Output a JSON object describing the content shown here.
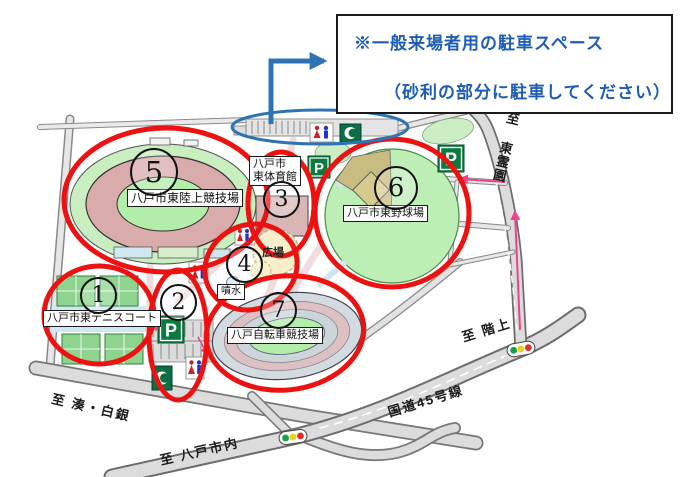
{
  "callout": {
    "line1": "※一般来場者用の駐車スペース",
    "line2": "（砂利の部分に駐車してください）"
  },
  "markers": [
    {
      "num": "1",
      "circled": "①",
      "label": "八戸市東テニスコート"
    },
    {
      "num": "2",
      "circled": "②",
      "label": ""
    },
    {
      "num": "3",
      "circled": "③",
      "label_line1": "八戸市",
      "label_line2": "東体育館"
    },
    {
      "num": "4",
      "circled": "④",
      "label": ""
    },
    {
      "num": "5",
      "circled": "⑤",
      "label": "八戸市東陸上競技場"
    },
    {
      "num": "6",
      "circled": "⑥",
      "label": "八戸市東野球場"
    },
    {
      "num": "7",
      "circled": "⑦",
      "label": "八戸自転車競技場"
    }
  ],
  "area_labels": {
    "plaza": "広場",
    "fountain": "噴水"
  },
  "road_labels": {
    "to_minato_shirogane": "至 湊・白銀",
    "to_hachinohe_city": "至 八戸市内",
    "route_45": "国道45号線",
    "to_hashikami": "至 階上",
    "to_higashi_reien": "至 東霊園"
  },
  "icons": {
    "parking_label": "P"
  },
  "colors": {
    "highlight_red": "#ee1111",
    "highlight_blue": "#2e74b5",
    "callout_text": "#1e5cb5",
    "parking_sign_green": "#0b7a3e"
  }
}
